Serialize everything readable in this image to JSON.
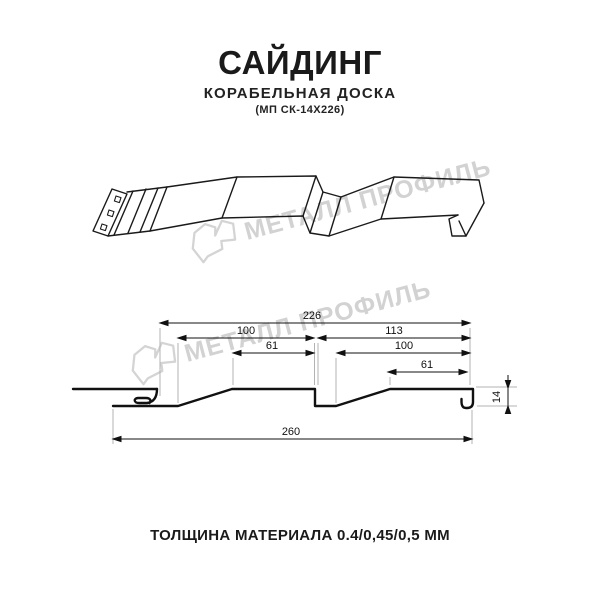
{
  "header": {
    "title": "САЙДИНГ",
    "subtitle": "КОРАБЕЛЬНАЯ ДОСКА",
    "model": "(МП СК-14Х226)"
  },
  "footer": {
    "thickness_text": "ТОЛЩИНА МАТЕРИАЛА 0.4/0,45/0,5 ММ"
  },
  "watermark": {
    "brand_text": "МЕТАЛЛ ПРОФИЛЬ",
    "logo_icon": "metall-profil-logo",
    "color": "#d2d2d2"
  },
  "drawing": {
    "views": [
      "isometric-profile-view",
      "cross-section-view"
    ],
    "dims": {
      "overall_width": "226",
      "left_panel": "100",
      "left_top_face": "61",
      "right_span": "113",
      "right_panel": "100",
      "right_top_face": "61",
      "profile_height": "14",
      "total_sheet_width": "260"
    }
  }
}
